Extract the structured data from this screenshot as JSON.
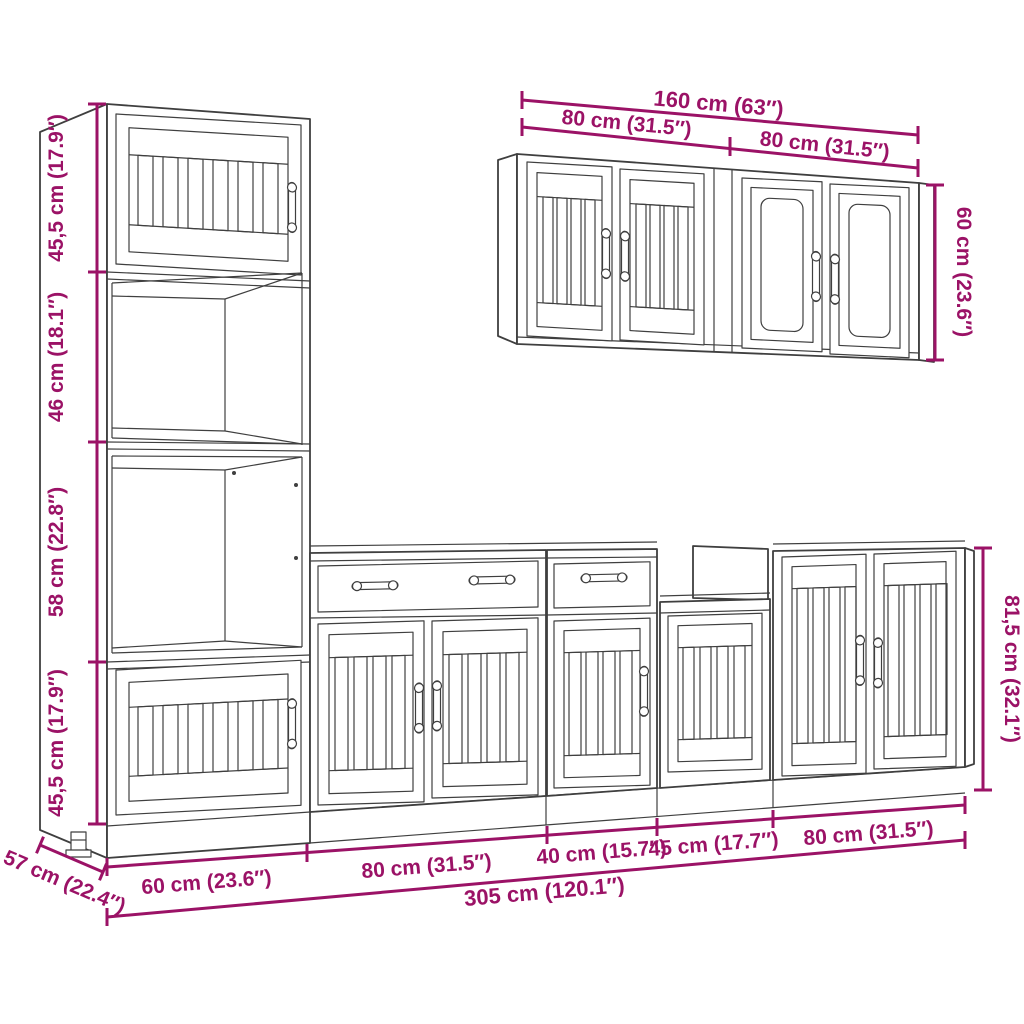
{
  "colors": {
    "dimension": "#9B1266",
    "outline": "#3F3F3F",
    "background": "#FFFFFF"
  },
  "dimensions": {
    "tall_cabinet": {
      "sections": [
        "45,5 cm (17.9″)",
        "46 cm (18.1″)",
        "58 cm (22.8″)",
        "45,5 cm (17.9″)"
      ],
      "depth": "57 cm (22.4″)"
    },
    "wall_cabinets": {
      "total_width": "160 cm (63″)",
      "left_width": "80 cm (31.5″)",
      "right_width": "80 cm (31.5″)",
      "height": "60 cm (23.6″)"
    },
    "base_row": {
      "unit_widths": [
        "60 cm (23.6″)",
        "80 cm (31.5″)",
        "40 cm (15.7″)",
        "45 cm (17.7″)",
        "80 cm (31.5″)"
      ],
      "total_width": "305 cm (120.1″)",
      "height": "81,5 cm (32.1″)"
    }
  }
}
